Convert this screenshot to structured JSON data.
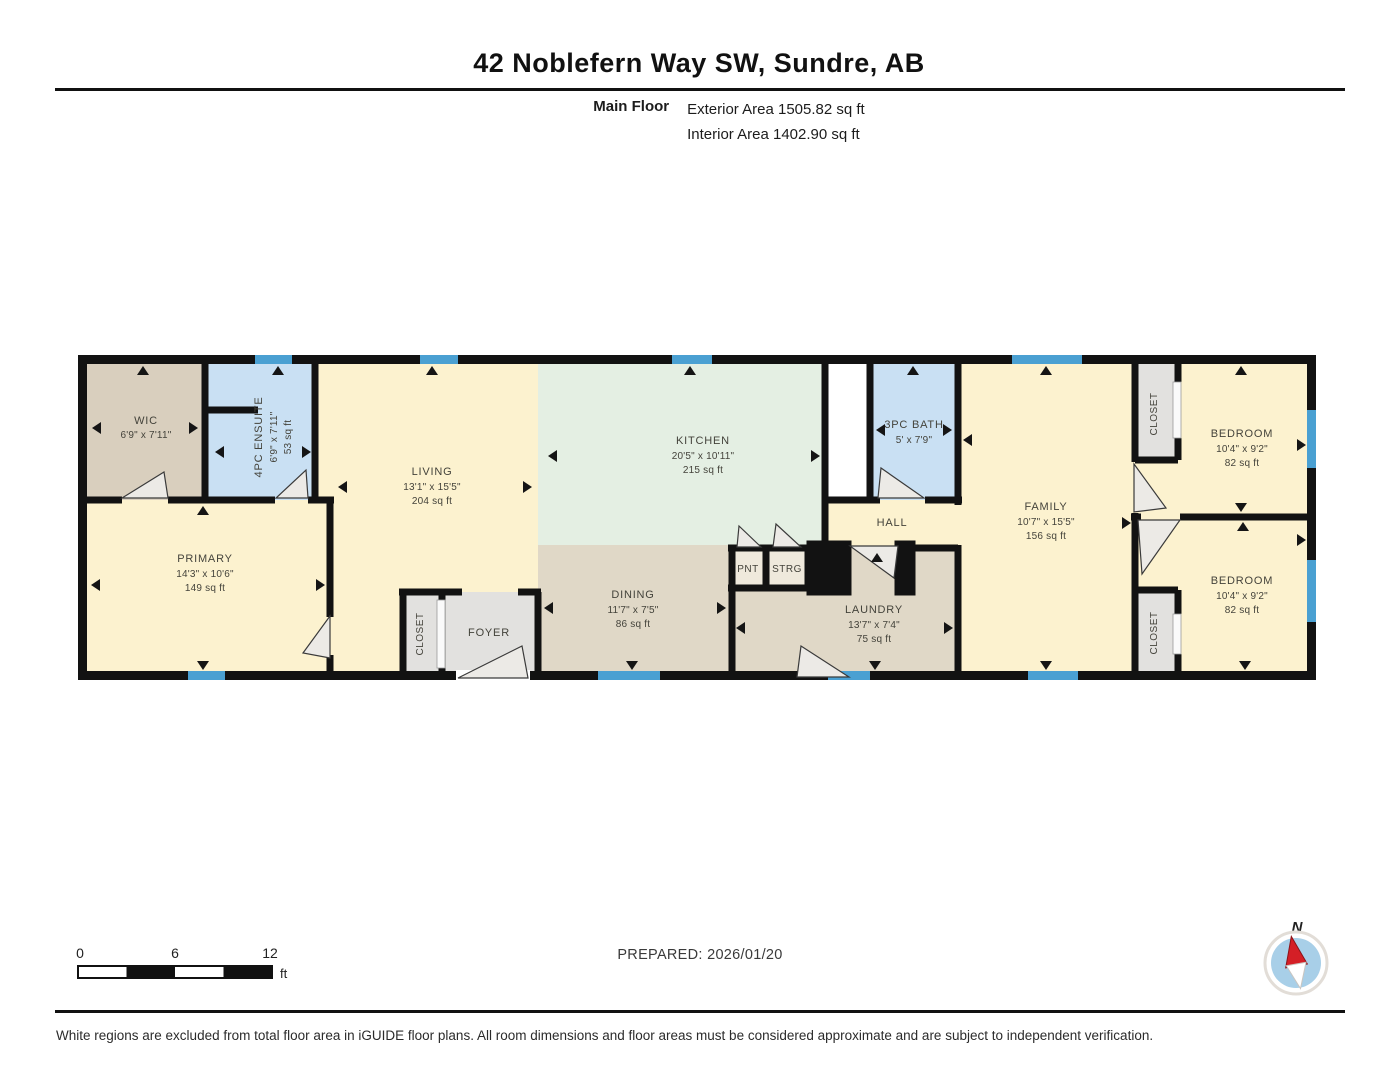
{
  "header": {
    "title": "42 Noblefern Way SW, Sundre, AB",
    "floor_label": "Main Floor",
    "exterior_area": "Exterior Area 1505.82 sq ft",
    "interior_area": "Interior Area 1402.90 sq ft"
  },
  "rooms": {
    "wic": {
      "name": "WIC",
      "dims": "6'9\" x 7'11\""
    },
    "ensuite": {
      "name": "4PC ENSUITE",
      "dims": "6'9\" x 7'11\"",
      "area": "53 sq ft"
    },
    "primary": {
      "name": "PRIMARY",
      "dims": "14'3\" x 10'6\"",
      "area": "149 sq ft"
    },
    "living": {
      "name": "LIVING",
      "dims": "13'1\" x 15'5\"",
      "area": "204 sq ft"
    },
    "foyer_closet": {
      "name": "CLOSET"
    },
    "foyer": {
      "name": "FOYER"
    },
    "kitchen": {
      "name": "KITCHEN",
      "dims": "20'5\" x 10'11\"",
      "area": "215 sq ft"
    },
    "dining": {
      "name": "DINING",
      "dims": "11'7\" x 7'5\"",
      "area": "86 sq ft"
    },
    "pantry": {
      "name": "PNT"
    },
    "storage": {
      "name": "STRG"
    },
    "laundry": {
      "name": "LAUNDRY",
      "dims": "13'7\" x 7'4\"",
      "area": "75 sq ft"
    },
    "bath": {
      "name": "3PC BATH",
      "dims": "5' x 7'9\""
    },
    "hall": {
      "name": "HALL"
    },
    "family": {
      "name": "FAMILY",
      "dims": "10'7\" x 15'5\"",
      "area": "156 sq ft"
    },
    "bedroom1_closet": {
      "name": "CLOSET"
    },
    "bedroom1": {
      "name": "BEDROOM",
      "dims": "10'4\" x 9'2\"",
      "area": "82 sq ft"
    },
    "bedroom2_closet": {
      "name": "CLOSET"
    },
    "bedroom2": {
      "name": "BEDROOM",
      "dims": "10'4\" x 9'2\"",
      "area": "82 sq ft"
    }
  },
  "footer": {
    "scale_ticks": [
      "0",
      "6",
      "12"
    ],
    "scale_unit": "ft",
    "prepared": "PREPARED: 2026/01/20",
    "compass_label": "N",
    "disclaimer": "White regions are excluded from total floor area in iGUIDE floor plans. All room dimensions and floor areas must be considered approximate and are subject to independent verification."
  },
  "colors": {
    "wall": "#121212",
    "room_cream": "#fcf2cf",
    "room_tan_dark": "#d9cfbe",
    "room_tan_light": "#e0d8c7",
    "room_blue": "#c9e0f3",
    "room_mint": "#e4efe3",
    "room_gray": "#e2e1df",
    "window_blue": "#4aa0d2",
    "compass_red": "#d41f26",
    "compass_disc": "#a8cfe8"
  }
}
